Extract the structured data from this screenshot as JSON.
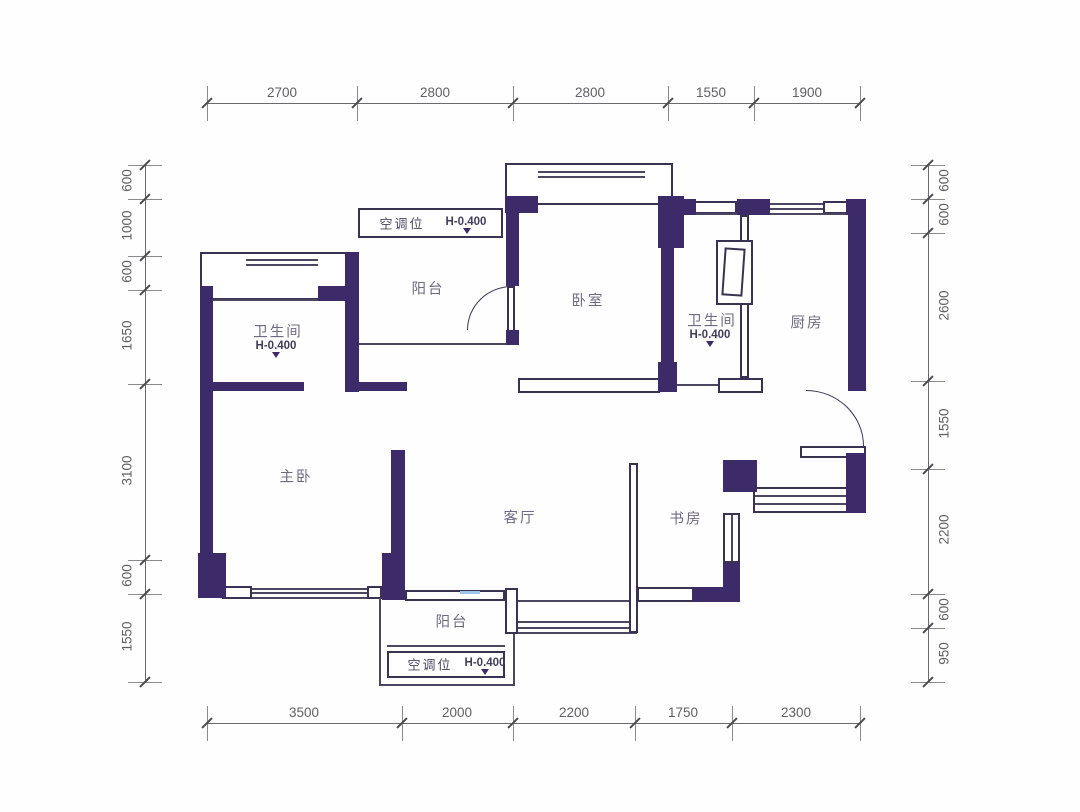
{
  "floorplan": {
    "rooms": {
      "balcony_top": "阳台",
      "bedroom": "卧室",
      "bath_left": "卫生间",
      "bath_right": "卫生间",
      "kitchen": "厨房",
      "master_bedroom": "主卧",
      "living_room": "客厅",
      "study": "书房",
      "balcony_bottom": "阳台"
    },
    "notes": {
      "ac_top_label": "空调位",
      "ac_top_level": "H-0.400",
      "ac_bottom_label": "空调位",
      "ac_bottom_level": "H-0.400",
      "bath_left_level": "H-0.400",
      "bath_right_level": "H-0.400"
    },
    "colors": {
      "wall": "#3d2a68",
      "thin_line": "#4c4660",
      "dim_text": "#5f5f63"
    },
    "dims": {
      "top": [
        "2700",
        "2800",
        "2800",
        "1550",
        "1900"
      ],
      "bottom": [
        "3500",
        "2000",
        "2200",
        "1750",
        "2300"
      ],
      "left": [
        "600",
        "1000",
        "600",
        "1650",
        "3100",
        "600",
        "1550"
      ],
      "right": [
        "600",
        "600",
        "2600",
        "1550",
        "2200",
        "600",
        "950"
      ]
    }
  }
}
